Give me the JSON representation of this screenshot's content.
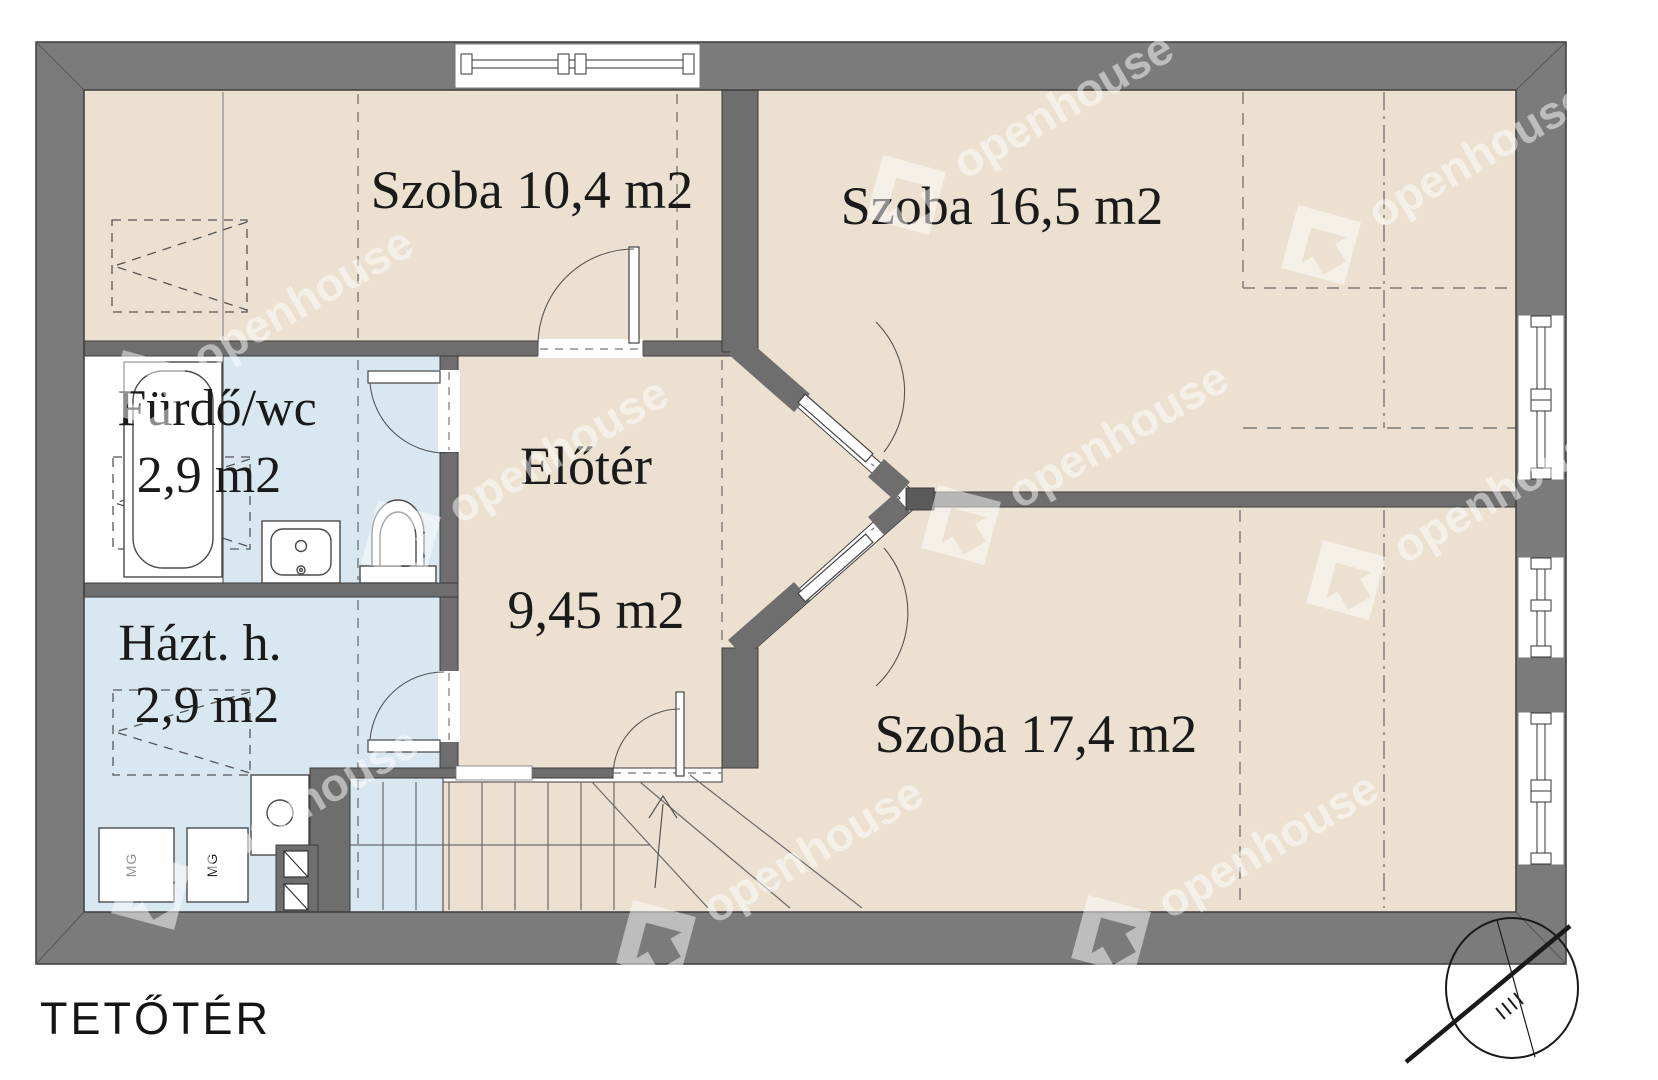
{
  "floor_plan": {
    "title": "TETŐTÉR",
    "rooms": [
      {
        "id": "szoba-1",
        "label": "Szoba 10,4 m2"
      },
      {
        "id": "szoba-2",
        "label": "Szoba 16,5 m2"
      },
      {
        "id": "szoba-3",
        "label": "Szoba 17,4 m2"
      },
      {
        "id": "eloter",
        "name": "Előtér",
        "area": "9,45 m2"
      },
      {
        "id": "furdo-wc",
        "name": "Fürdő/wc",
        "area": "2,9 m2"
      },
      {
        "id": "haztartasi-helyiseg",
        "name": "Házt. h.",
        "area": "2,9 m2"
      }
    ],
    "appliance_label": "MG",
    "watermark_text": "openhouse",
    "colors": {
      "wall": "#7b7b7b",
      "interior_wall": "#6e6e6e",
      "room_floor": "#ece1d0",
      "wet_room_floor": "#d9e7f1",
      "background": "#ffffff"
    }
  }
}
